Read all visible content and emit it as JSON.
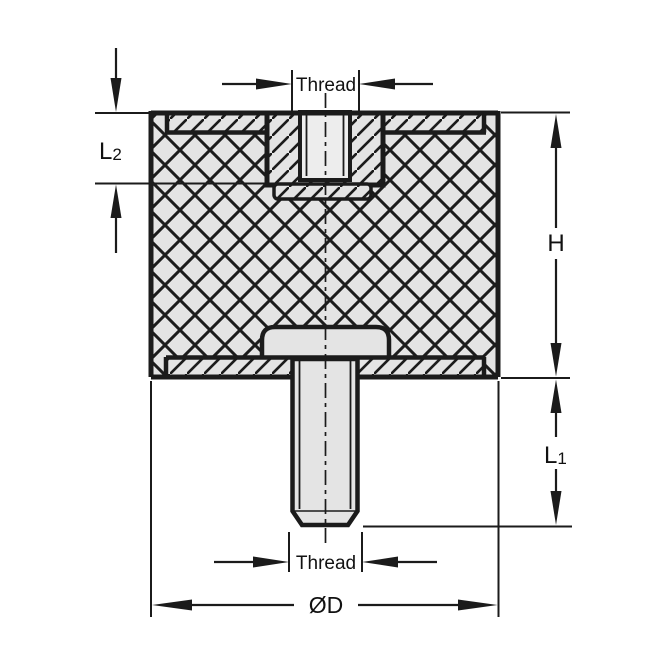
{
  "labels": {
    "thread_top": "Thread",
    "thread_bottom": "Thread",
    "height": "H",
    "diameter": "ØD",
    "l1": {
      "main": "L",
      "sub": "1"
    },
    "l2": {
      "main": "L",
      "sub": "2"
    }
  },
  "colors": {
    "background": "#ffffff",
    "line": "#1b1b1b",
    "material_fill": "#e4e4e4",
    "bore_fill": "#ededed"
  }
}
